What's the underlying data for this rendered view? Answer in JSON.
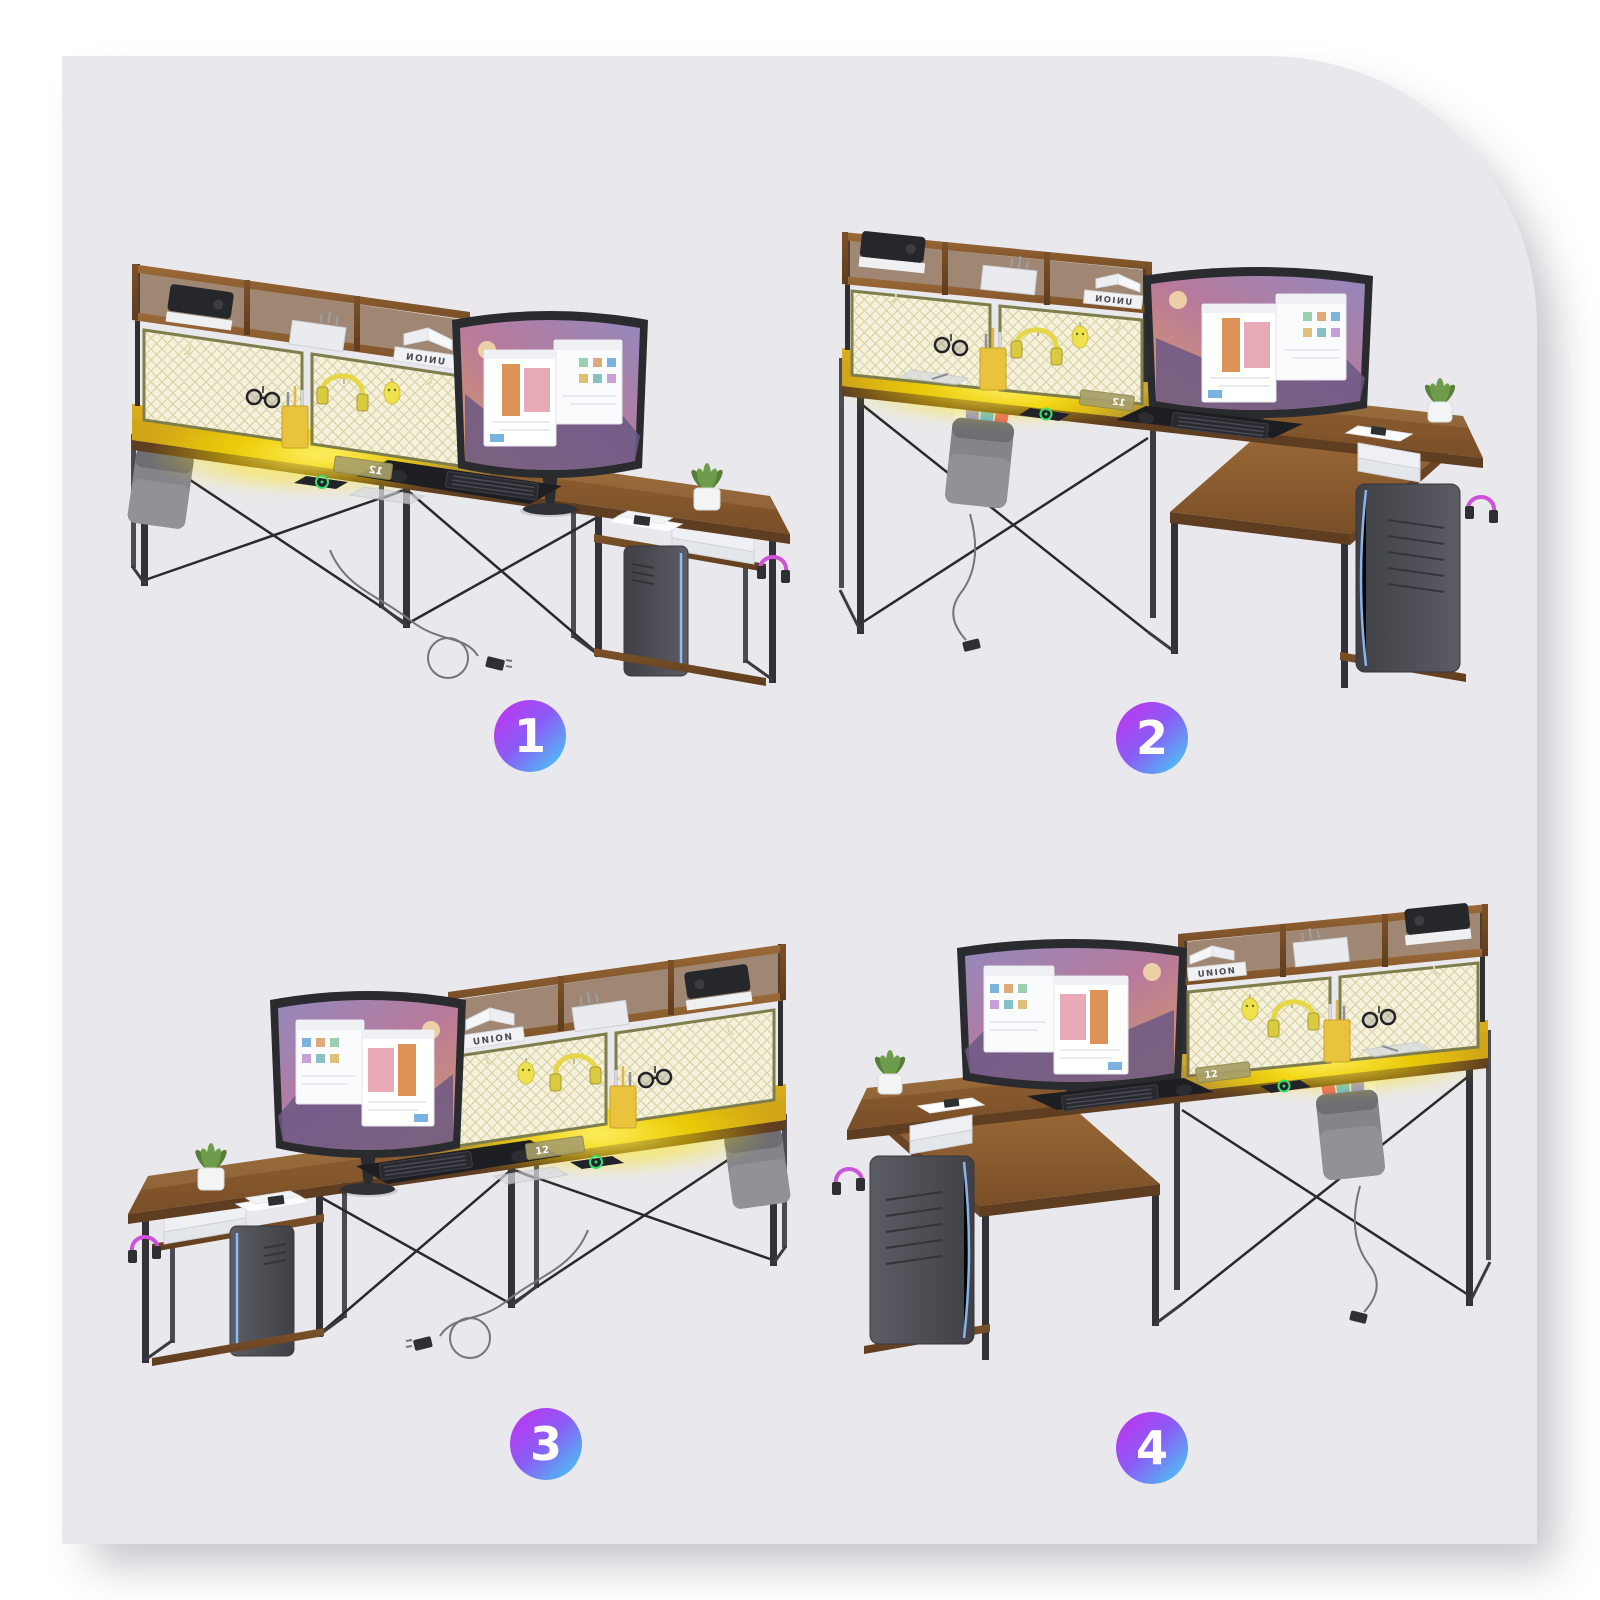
{
  "page": {
    "background_color": "#ffffff",
    "card_color": "#e9e8ec",
    "card_shape": "large rounded top-right corner with soft drop shadow"
  },
  "badges": [
    {
      "label": "1"
    },
    {
      "label": "2"
    },
    {
      "label": "3"
    },
    {
      "label": "4"
    }
  ],
  "badge_style": {
    "gradient_start": "#c72ef0",
    "gradient_end": "#3fd4f4",
    "text_color": "#ffffff"
  },
  "scene_content": {
    "book_label": "UNION",
    "clock_display": "12"
  },
  "scenes": [
    {
      "number": "1",
      "desk_type": "straight desk with hutch",
      "hutch_side": "left",
      "monitor_side": "right",
      "pc_tower_side": "right",
      "storage_bag_side": "left",
      "power_cord": "on floor",
      "book_label_mirrored": true
    },
    {
      "number": "2",
      "desk_type": "L-shaped desk with hutch",
      "hutch_side": "left",
      "monitor_side": "corner right",
      "pc_tower_side": "front right",
      "storage_bag_side": "left",
      "power_cord": "on floor",
      "book_label_mirrored": true
    },
    {
      "number": "3",
      "desk_type": "straight desk with hutch",
      "hutch_side": "right",
      "monitor_side": "left",
      "pc_tower_side": "left",
      "storage_bag_side": "right",
      "power_cord": "on floor",
      "book_label_mirrored": false
    },
    {
      "number": "4",
      "desk_type": "L-shaped desk with hutch",
      "hutch_side": "right",
      "monitor_side": "corner left",
      "pc_tower_side": "front left",
      "storage_bag_side": "right",
      "power_cord": "on floor",
      "book_label_mirrored": false
    }
  ],
  "colors": {
    "desk_wood": "#8a5a2e",
    "frame_metal": "#323237",
    "led_glow": "#ffe400",
    "mesh_panel": "#f5f1dc",
    "monitor_wallpaper": "#9488bc",
    "pc_tower": "#54555c",
    "pc_led": "#8fc1ff",
    "plant_green": "#6f9c4a",
    "bag_fabric": "#84848b",
    "hanging_headphones": "#e6d648",
    "hook_headphones": "#cc52d8",
    "wireless_charger_ring": "#39df6d"
  }
}
